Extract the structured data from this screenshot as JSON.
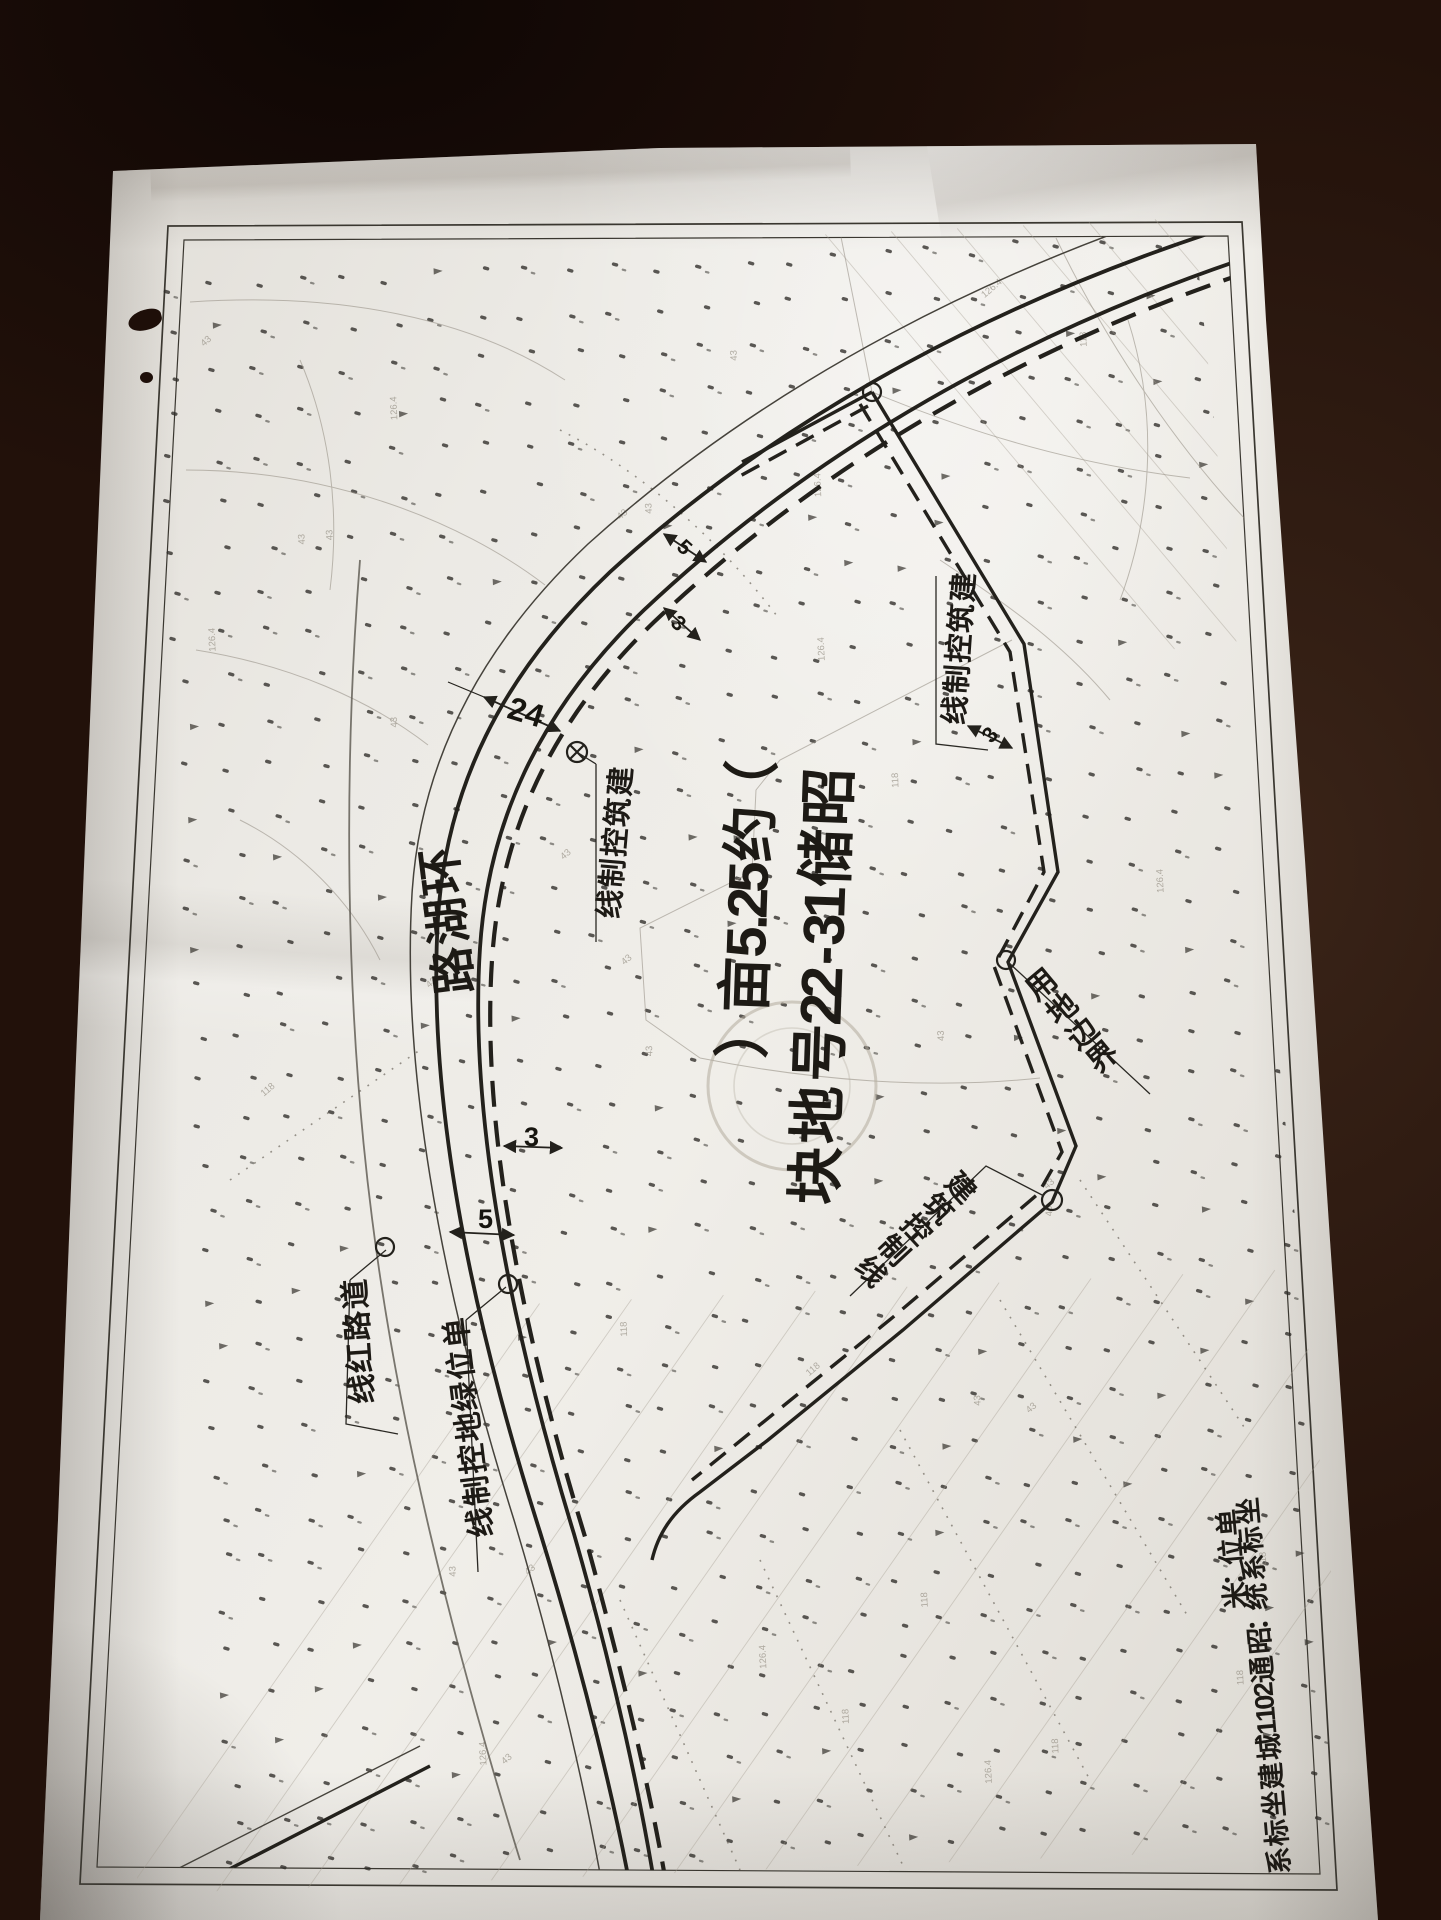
{
  "map": {
    "parcel_title": "昭储13-22号地块",
    "parcel_area": "（约52.5亩）",
    "road_name": "环湖路",
    "labels": {
      "building_control_line": "建筑控制线",
      "land_use_boundary": "用地边界",
      "road_red_line": "道路红线",
      "unit_green_control_line": "单位绿地控制线"
    },
    "margin_notes": {
      "coordinate_system": "坐标系统：昭通2011城建坐标系",
      "unit": "单位：米"
    },
    "dimensions": {
      "road_width": "24",
      "offset_5_upper": "5",
      "offset_3_upper": "3",
      "offset_3_east": "3",
      "offset_3_lower": "3",
      "offset_5_lower": "5"
    },
    "ink_color": "#23211c",
    "paper_color": "#e9e7e2"
  }
}
